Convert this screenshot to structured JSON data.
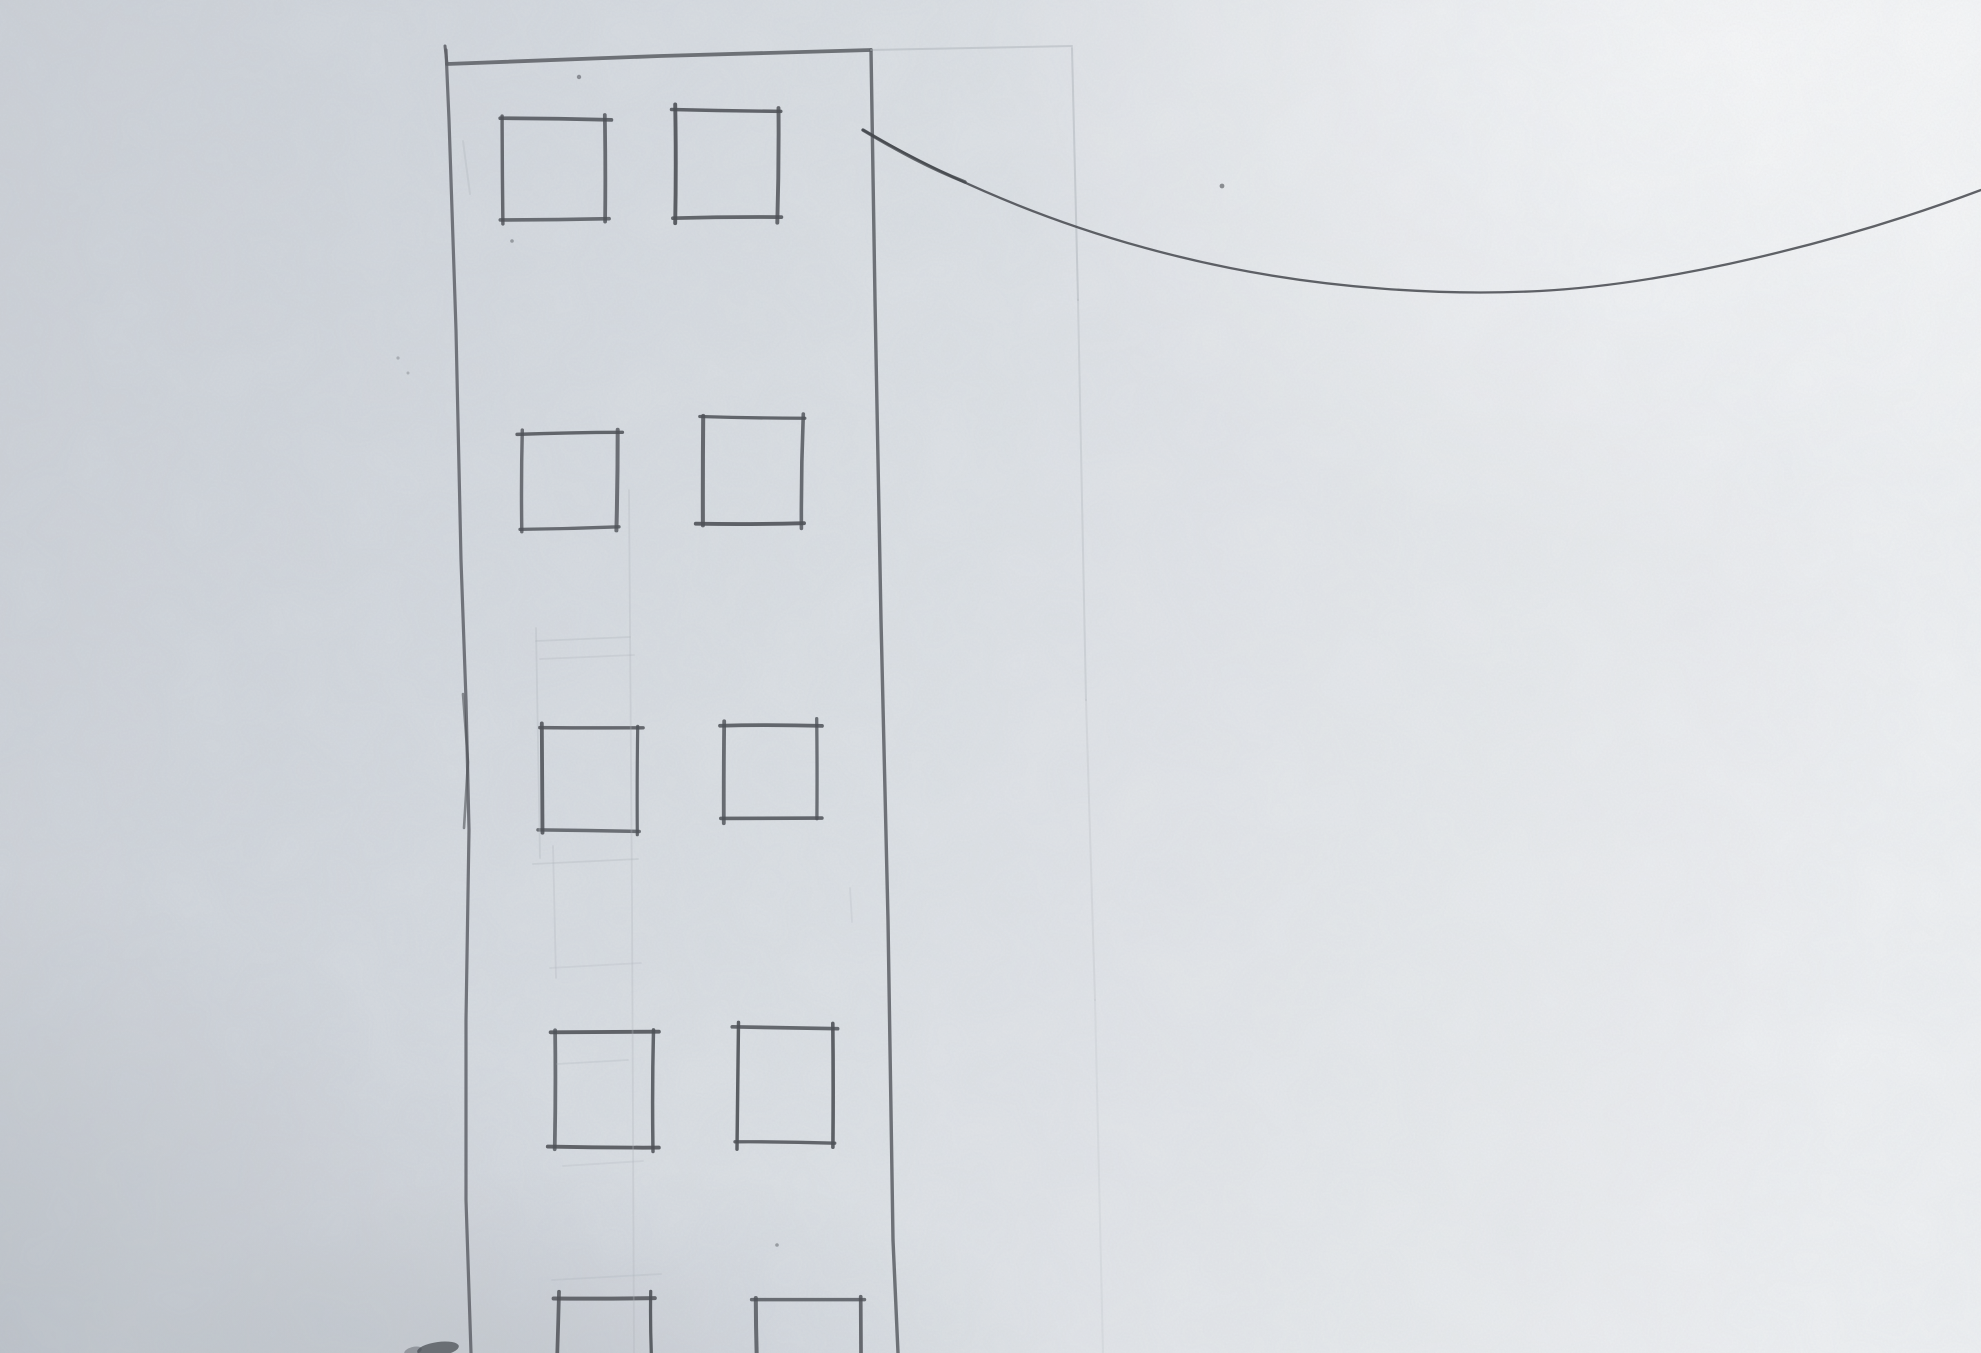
{
  "canvas": {
    "width": 1981,
    "height": 1353
  },
  "palette": {
    "paper_bright": "#eff1f3",
    "paper_mid": "#dcе0e5",
    "paper_mid_fix": "#dce0e5",
    "paper_shadow": "#ccd1d7",
    "pencil_dark": "#4e5157",
    "pencil_mid": "#5f6268",
    "pencil_faint": "#aeb3ba",
    "wire_color": "#45484e",
    "smudge": "#45484e"
  },
  "sketch": {
    "building": {
      "top_tick": {
        "name": "building-top-left-tick",
        "points": [
          [
            445,
            46
          ],
          [
            447,
            64
          ]
        ],
        "width": 3.0,
        "opacity": 0.9
      },
      "top_edge": {
        "name": "building-top-edge",
        "points": [
          [
            447,
            64
          ],
          [
            660,
            56
          ],
          [
            871,
            50
          ]
        ],
        "width": 3.8,
        "opacity": 0.88
      },
      "left_edge": {
        "name": "building-left-edge",
        "points": [
          [
            446,
            50
          ],
          [
            449,
            120
          ],
          [
            456,
            330
          ],
          [
            461,
            560
          ],
          [
            466,
            700
          ],
          [
            469,
            830
          ],
          [
            466,
            1020
          ],
          [
            466,
            1200
          ],
          [
            471,
            1353
          ]
        ],
        "width": 3.2,
        "opacity": 0.85
      },
      "left_edge_retrace": {
        "name": "building-left-edge-retrace",
        "points": [
          [
            463,
            694
          ],
          [
            468,
            762
          ],
          [
            464,
            828
          ]
        ],
        "width": 2.6,
        "opacity": 0.6
      },
      "right_edge": {
        "name": "building-right-edge",
        "points": [
          [
            871,
            50
          ],
          [
            875,
            300
          ],
          [
            881,
            620
          ],
          [
            888,
            920
          ],
          [
            893,
            1240
          ],
          [
            898,
            1353
          ]
        ],
        "width": 3.4,
        "opacity": 0.88
      }
    },
    "windows": [
      {
        "name": "window-row1-left",
        "x1": 503,
        "y1": 119,
        "x2": 605,
        "y2": 219
      },
      {
        "name": "window-row1-right",
        "x1": 675,
        "y1": 110,
        "x2": 778,
        "y2": 218
      },
      {
        "name": "window-row2-left",
        "x1": 523,
        "y1": 433,
        "x2": 617,
        "y2": 528
      },
      {
        "name": "window-row2-right",
        "x1": 702,
        "y1": 418,
        "x2": 802,
        "y2": 523
      },
      {
        "name": "window-row3-left",
        "x1": 543,
        "y1": 728,
        "x2": 637,
        "y2": 830
      },
      {
        "name": "window-row3-right",
        "x1": 724,
        "y1": 725,
        "x2": 817,
        "y2": 817
      },
      {
        "name": "window-row4-left",
        "x1": 554,
        "y1": 1033,
        "x2": 654,
        "y2": 1147
      },
      {
        "name": "window-row4-right",
        "x1": 738,
        "y1": 1028,
        "x2": 833,
        "y2": 1143
      },
      {
        "name": "window-row5-left",
        "x1": 558,
        "y1": 1297,
        "x2": 652,
        "y2": 1368
      },
      {
        "name": "window-row5-right",
        "x1": 756,
        "y1": 1300,
        "x2": 860,
        "y2": 1368
      }
    ],
    "faint_lines": [
      {
        "name": "roof-extension-guide",
        "points": [
          [
            871,
            50
          ],
          [
            1072,
            46
          ]
        ],
        "width": 2.0,
        "opacity": 0.5
      },
      {
        "name": "right-guide-vertical-1",
        "points": [
          [
            1072,
            48
          ],
          [
            1078,
            300
          ]
        ],
        "width": 2.0,
        "opacity": 0.5
      },
      {
        "name": "right-guide-vertical-2",
        "points": [
          [
            1078,
            300
          ],
          [
            1086,
            700
          ]
        ],
        "width": 2.0,
        "opacity": 0.34
      },
      {
        "name": "right-guide-vertical-3",
        "points": [
          [
            1086,
            700
          ],
          [
            1095,
            1000
          ]
        ],
        "width": 2.0,
        "opacity": 0.24
      },
      {
        "name": "right-guide-vertical-4",
        "points": [
          [
            1095,
            1000
          ],
          [
            1103,
            1353
          ]
        ],
        "width": 2.0,
        "opacity": 0.17
      },
      {
        "name": "center-guide-vertical",
        "points": [
          [
            629,
            490
          ],
          [
            632,
            900
          ],
          [
            634,
            1353
          ]
        ],
        "width": 1.8,
        "opacity": 0.3
      },
      {
        "name": "inner-guide-vertical-a",
        "points": [
          [
            536,
            628
          ],
          [
            540,
            858
          ]
        ],
        "width": 1.8,
        "opacity": 0.32
      },
      {
        "name": "inner-guide-vertical-b",
        "points": [
          [
            553,
            846
          ],
          [
            556,
            978
          ]
        ],
        "width": 1.8,
        "opacity": 0.27
      },
      {
        "name": "inner-guide-h1",
        "points": [
          [
            536,
            641
          ],
          [
            630,
            637
          ]
        ],
        "width": 1.8,
        "opacity": 0.32
      },
      {
        "name": "inner-guide-h2",
        "points": [
          [
            540,
            659
          ],
          [
            634,
            655
          ]
        ],
        "width": 1.8,
        "opacity": 0.27
      },
      {
        "name": "inner-guide-h3",
        "points": [
          [
            533,
            864
          ],
          [
            638,
            859
          ]
        ],
        "width": 1.8,
        "opacity": 0.32
      },
      {
        "name": "inner-guide-h4",
        "points": [
          [
            550,
            968
          ],
          [
            641,
            963
          ]
        ],
        "width": 1.8,
        "opacity": 0.25
      },
      {
        "name": "inner-guide-h5",
        "points": [
          [
            557,
            1064
          ],
          [
            628,
            1060
          ]
        ],
        "width": 1.8,
        "opacity": 0.28
      },
      {
        "name": "inner-guide-h6",
        "points": [
          [
            563,
            1166
          ],
          [
            643,
            1161
          ]
        ],
        "width": 1.8,
        "opacity": 0.25
      },
      {
        "name": "inner-guide-h7",
        "points": [
          [
            552,
            1280
          ],
          [
            661,
            1274
          ]
        ],
        "width": 1.8,
        "opacity": 0.28
      },
      {
        "name": "stray-diagonal-mark",
        "points": [
          [
            463,
            141
          ],
          [
            470,
            194
          ]
        ],
        "width": 2.0,
        "opacity": 0.32
      },
      {
        "name": "stray-tick-mark",
        "points": [
          [
            850,
            888
          ],
          [
            852,
            922
          ]
        ],
        "width": 1.8,
        "opacity": 0.22
      }
    ],
    "wire": {
      "name": "hanging-wire-curve",
      "path": "M 863 130 C 960 186 1080 238 1230 268 C 1330 288 1440 296 1540 291 C 1670 284 1840 243 1981 190",
      "width": 2.3,
      "opacity": 0.85,
      "start_overlay": {
        "path": "M 863 130 C 900 152 930 168 965 182",
        "width": 3.4,
        "opacity": 0.8
      }
    },
    "specks": [
      {
        "name": "paper-speck",
        "x": 579,
        "y": 77,
        "r": 2.2,
        "o": 0.55
      },
      {
        "name": "paper-speck",
        "x": 512,
        "y": 241,
        "r": 1.8,
        "o": 0.45
      },
      {
        "name": "paper-speck",
        "x": 1222,
        "y": 186,
        "r": 2.4,
        "o": 0.6
      },
      {
        "name": "paper-speck",
        "x": 777,
        "y": 1245,
        "r": 1.8,
        "o": 0.45
      },
      {
        "name": "paper-speck",
        "x": 398,
        "y": 358,
        "r": 1.6,
        "o": 0.3
      },
      {
        "name": "paper-speck",
        "x": 408,
        "y": 373,
        "r": 1.5,
        "o": 0.28
      }
    ],
    "smudges": [
      {
        "name": "bottom-edge-smudge",
        "cx": 438,
        "cy": 1349,
        "rx": 21,
        "ry": 7,
        "rot": -8,
        "o": 0.7
      },
      {
        "name": "bottom-edge-smudge",
        "cx": 413,
        "cy": 1351,
        "rx": 9,
        "ry": 4,
        "rot": -15,
        "o": 0.38
      }
    ]
  },
  "lighting": {
    "highlight_at": [
      0.88,
      0.03
    ],
    "shadow_at": [
      0.0,
      1.08
    ]
  }
}
